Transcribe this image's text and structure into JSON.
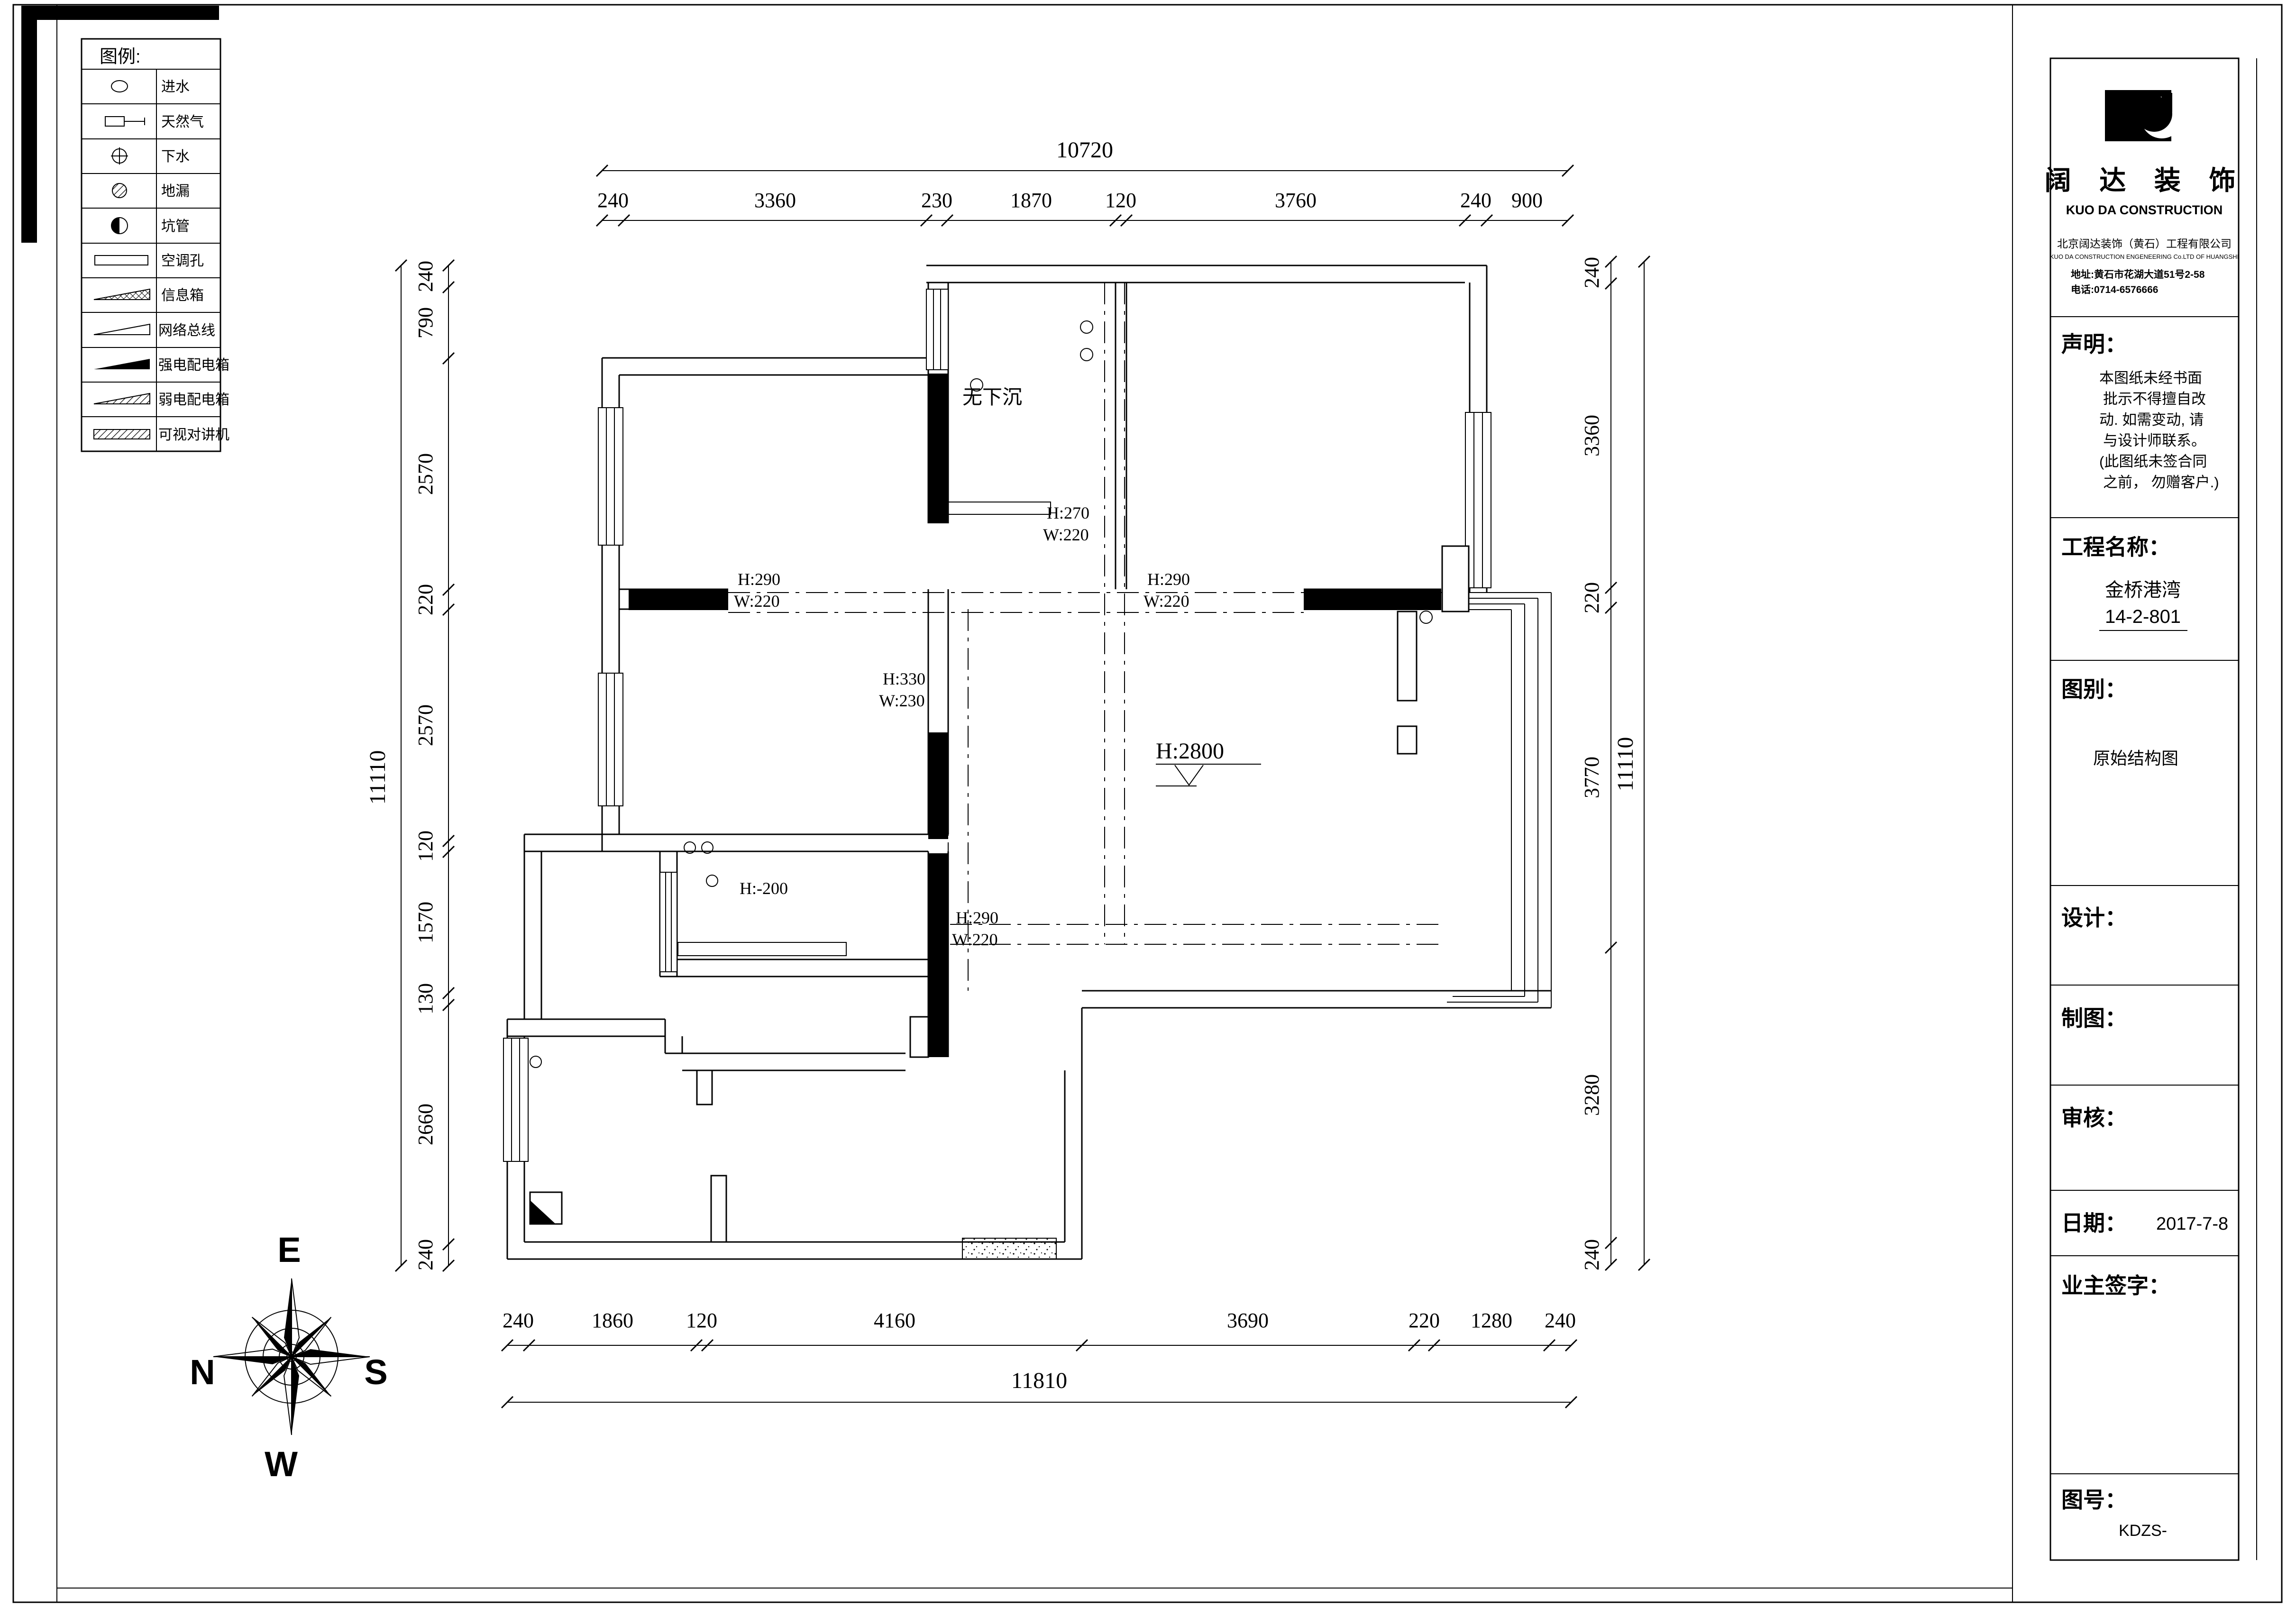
{
  "legend": {
    "title": "图例:",
    "items": [
      {
        "icon": "water-inlet-icon",
        "label": "进水"
      },
      {
        "icon": "gas-icon",
        "label": "天然气"
      },
      {
        "icon": "sewer-icon",
        "label": "下水"
      },
      {
        "icon": "floor-drain-icon",
        "label": "地漏"
      },
      {
        "icon": "pit-pipe-icon",
        "label": "坑管"
      },
      {
        "icon": "ac-hole-icon",
        "label": "空调孔"
      },
      {
        "icon": "info-box-icon",
        "label": "信息箱"
      },
      {
        "icon": "network-bus-icon",
        "label": "网络总线"
      },
      {
        "icon": "strong-power-box-icon",
        "label": "强电配电箱"
      },
      {
        "icon": "weak-power-box-icon",
        "label": "弱电配电箱"
      },
      {
        "icon": "video-intercom-icon",
        "label": "可视对讲机"
      }
    ]
  },
  "compass": {
    "n": "N",
    "e": "E",
    "s": "S",
    "w": "W"
  },
  "plan": {
    "note": "无下沉",
    "level": "H:2800",
    "drop": "H:-200",
    "beams": [
      {
        "h": "H:270",
        "w": "W:220"
      },
      {
        "h": "H:290",
        "w": "W:220"
      },
      {
        "h": "H:290",
        "w": "W:220"
      },
      {
        "h": "H:330",
        "w": "W:230"
      },
      {
        "h": "H:290",
        "w": "W:220"
      }
    ]
  },
  "dimensions": {
    "top": {
      "total": "10720",
      "segments": [
        "240",
        "3360",
        "230",
        "1870",
        "120",
        "3760",
        "240",
        "900"
      ]
    },
    "bottom": {
      "total": "11810",
      "segments": [
        "240",
        "1860",
        "120",
        "4160",
        "3690",
        "220",
        "1280",
        "240"
      ]
    },
    "left": {
      "total": "11110",
      "segments": [
        "240",
        "790",
        "2570",
        "220",
        "2570",
        "120",
        "1570",
        "130",
        "2660",
        "240"
      ]
    },
    "right": {
      "total": "11110",
      "segments": [
        "240",
        "3360",
        "220",
        "3770",
        "3280",
        "240"
      ]
    }
  },
  "titleblock": {
    "logo_cn": "阔 达 装 饰",
    "logo_en": "KUO DA CONSTRUCTION",
    "company_cn": "北京阔达装饰（黄石）工程有限公司",
    "company_en": "KUO DA CONSTRUCTION ENGENEERING Co.LTD OF HUANGSHI",
    "address": "地址:黄石市花湖大道51号2-58",
    "phone": "电话:0714-6576666",
    "statement_title": "声明：",
    "statement_lines": [
      "本图纸未经书面",
      "批示不得擅自改",
      "动. 如需变动, 请",
      "与设计师联系。",
      "(此图纸未签合同",
      "之前， 勿赠客户.)"
    ],
    "project_label": "工程名称：",
    "project_name": "金桥港湾",
    "project_unit": "14-2-801",
    "type_label": "图别：",
    "type_value": "原始结构图",
    "design_label": "设计：",
    "draft_label": "制图：",
    "review_label": "审核：",
    "date_label": "日期：",
    "date_value": "2017-7-8",
    "owner_label": "业主签字：",
    "number_label": "图号：",
    "number_value": "KDZS-"
  }
}
